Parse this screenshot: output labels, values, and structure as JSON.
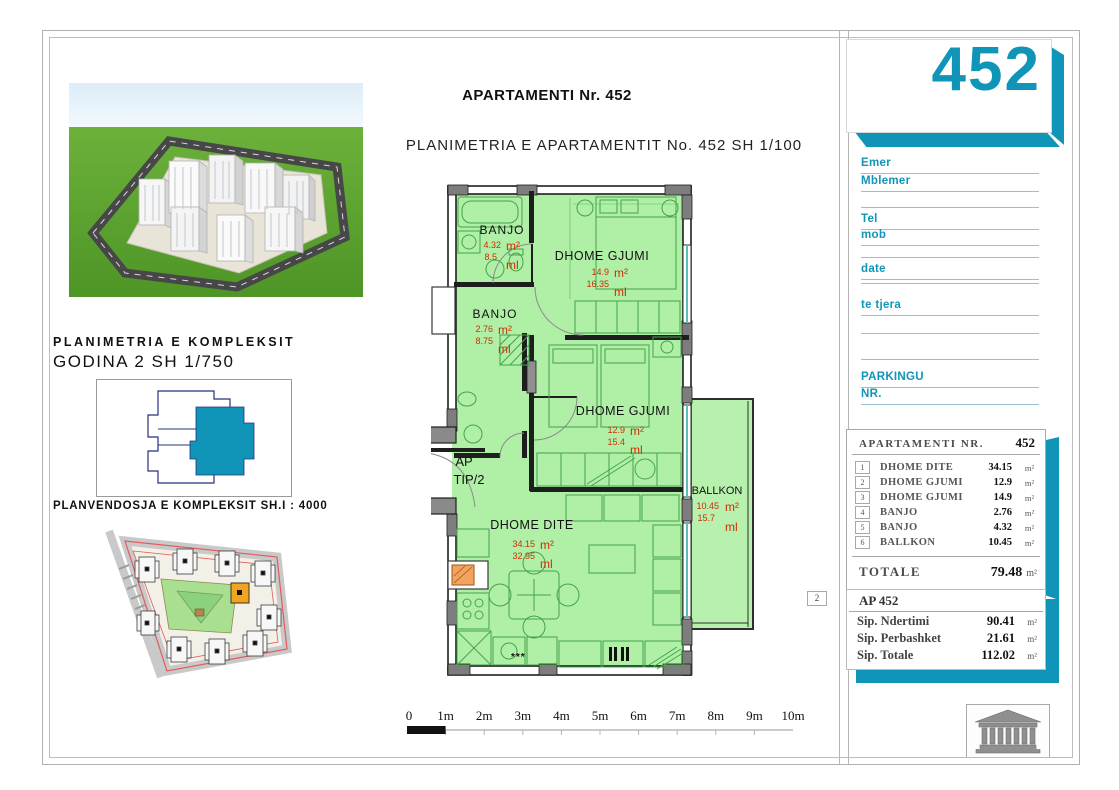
{
  "titles": {
    "main": "APARTAMENTI Nr. 452",
    "sub": "PLANIMETRIA E APARTAMENTIT No. 452 SH 1/100"
  },
  "left": {
    "kompleks_line1": "PLANIMETRIA E KOMPLEKSIT",
    "kompleks_line2": "GODINA 2  SH 1/750",
    "planvendosja": "PLANVENDOSJA E KOMPLEKSIT SH.I : 4000"
  },
  "banner": {
    "number": "452"
  },
  "form": {
    "rows": [
      "Emer",
      "Mblemer",
      "Tel",
      "mob",
      "date",
      "te tjera"
    ],
    "parking_line1": "PARKINGU",
    "parking_line2": "NR."
  },
  "rooms_table": {
    "header_label": "APARTAMENTI  NR.",
    "header_number": "452",
    "rows": [
      {
        "n": "1",
        "name": "DHOME DITE",
        "value": "34.15",
        "unit": "m²"
      },
      {
        "n": "2",
        "name": "DHOME GJUMI",
        "value": "12.9",
        "unit": "m²"
      },
      {
        "n": "3",
        "name": "DHOME GJUMI",
        "value": "14.9",
        "unit": "m²"
      },
      {
        "n": "4",
        "name": "BANJO",
        "value": "2.76",
        "unit": "m²"
      },
      {
        "n": "5",
        "name": "BANJO",
        "value": "4.32",
        "unit": "m²"
      },
      {
        "n": "6",
        "name": "BALLKON",
        "value": "10.45",
        "unit": "m²"
      }
    ],
    "total_label": "TOTALE",
    "total_value": "79.48",
    "total_unit": "m²"
  },
  "summary_table": {
    "index": "2",
    "title": "AP 452",
    "rows": [
      {
        "name": "Sip. Ndertimi",
        "value": "90.41",
        "unit": "m²"
      },
      {
        "name": "Sip. Perbashket",
        "value": "21.61",
        "unit": "m²"
      },
      {
        "name": "Sip. Totale",
        "value": "112.02",
        "unit": "m²"
      }
    ]
  },
  "plan": {
    "entry_line1": "AP",
    "entry_line2": "TIP/2",
    "unit_area": "m²",
    "unit_perim": "ml",
    "stars": "***",
    "rooms": [
      {
        "name": "BANJO",
        "area": "4.32",
        "perim": "8.5"
      },
      {
        "name": "BANJO",
        "area": "2.76",
        "perim": "8.75"
      },
      {
        "name": "DHOME GJUMI",
        "area": "14.9",
        "perim": "16.35"
      },
      {
        "name": "DHOME GJUMI",
        "area": "12.9",
        "perim": "15.4"
      },
      {
        "name": "DHOME DITE",
        "area": "34.15",
        "perim": "32.95"
      },
      {
        "name": "BALLKON",
        "area": "10.45",
        "perim": "15.7"
      }
    ]
  },
  "scalebar": {
    "labels": [
      "0",
      "1m",
      "2m",
      "3m",
      "4m",
      "5m",
      "6m",
      "7m",
      "8m",
      "9m",
      "10m"
    ]
  },
  "colors": {
    "teal": "#1095b8",
    "room_green": "#b0f0a6",
    "balcony_green": "#b7f1ad",
    "furniture_green": "#44a24b",
    "value_red": "#cc2e04",
    "wall_black": "#1e1e1e",
    "site_orange": "#f3a41f"
  }
}
